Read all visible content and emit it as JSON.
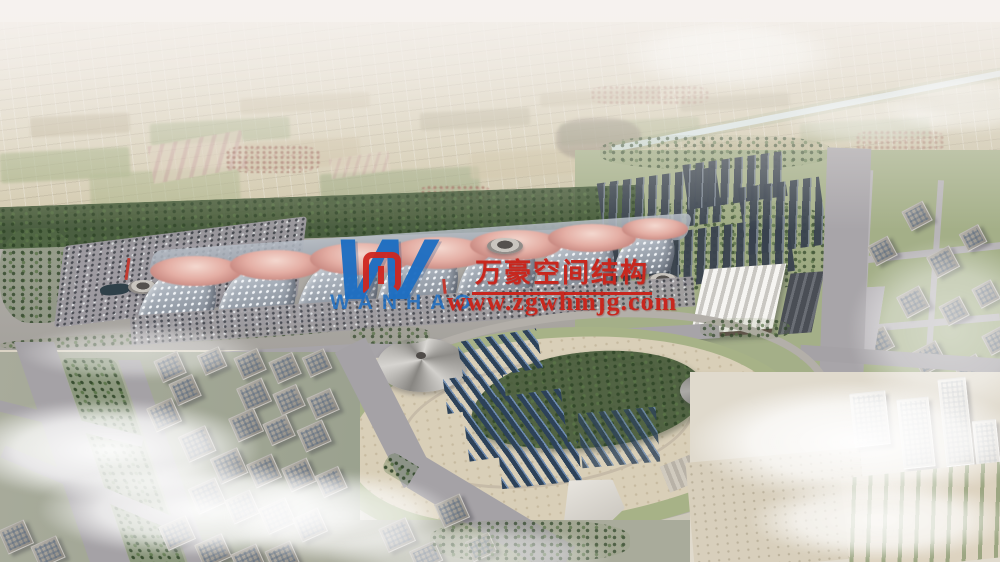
{
  "watermark": {
    "logo_letter": "W",
    "logo_text": "WANHAO",
    "company_cn": "万豪空间结构",
    "url": "www.zgwhmjg.com",
    "colors": {
      "logo_blue": "#1d6ec2",
      "text_red": "#c8271e"
    }
  },
  "palette": {
    "sky_haze": "#f3efec",
    "farmland": "#cfc4a4",
    "hall_roof": "#b2bac4",
    "canopy_pink": "#e2aca2",
    "solar_panel": "#3a4450",
    "park_plaza": "#d9cfb8",
    "greenery": "#6f855c",
    "road": "#a5a2a6",
    "cloud": "#ffffff"
  }
}
